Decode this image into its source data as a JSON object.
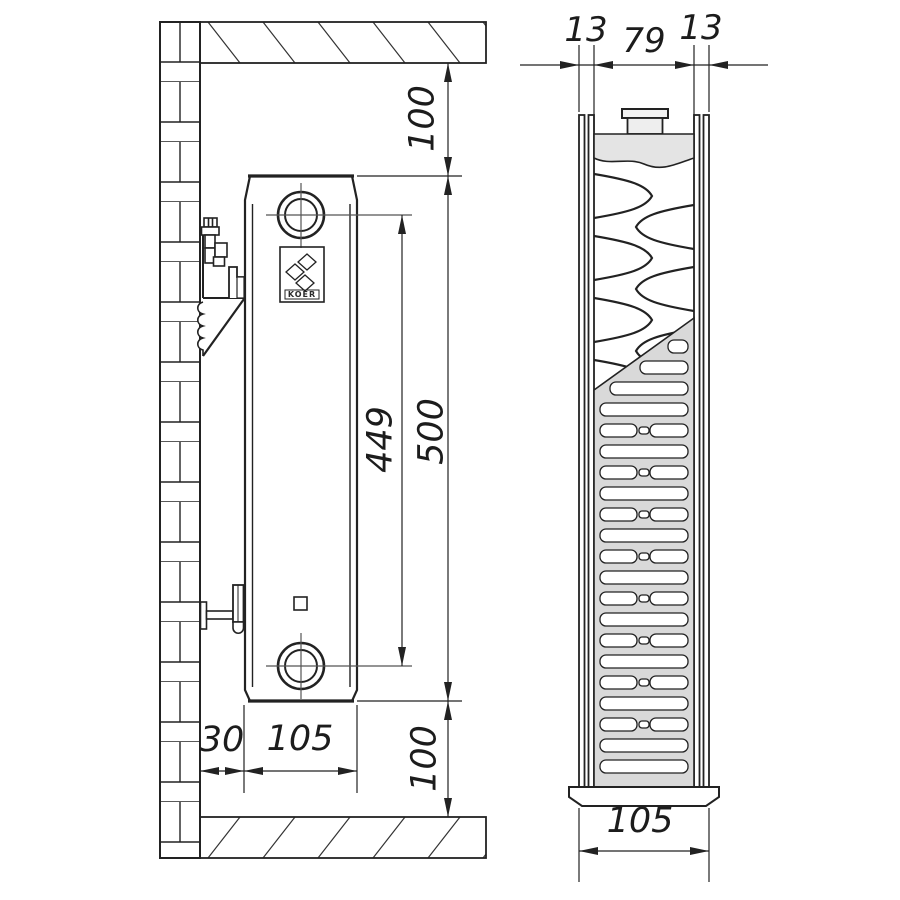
{
  "side_view": {
    "top_clearance_mm": "100",
    "connection_spacing_mm": "449",
    "radiator_height_mm": "500",
    "bottom_clearance_mm": "100",
    "wall_gap_mm": "30",
    "depth_mm": "105",
    "brand": "KOER"
  },
  "section_view": {
    "front_panel_mm": "13",
    "core_mm": "79",
    "rear_panel_mm": "13",
    "depth_mm": "105"
  },
  "colors": {
    "line": "#222222",
    "header_fill": "#e4e4e4",
    "grille_fill": "#d9d9d9"
  }
}
